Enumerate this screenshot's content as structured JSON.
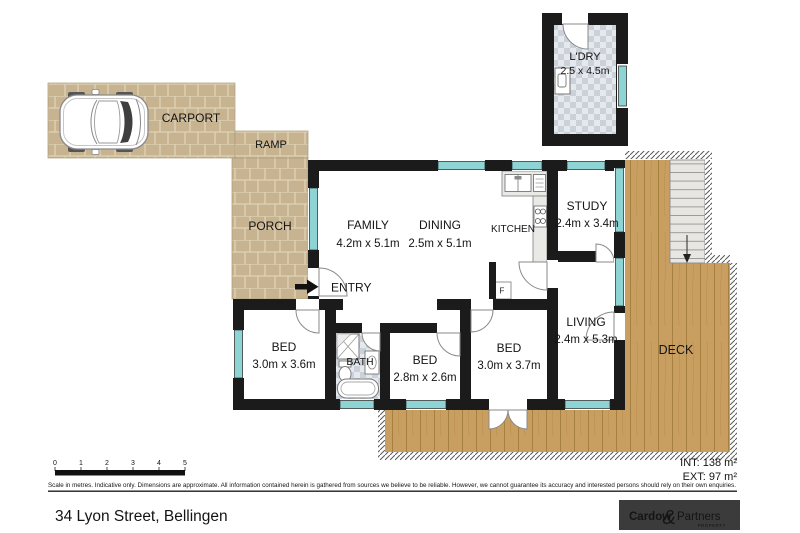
{
  "plan": {
    "rooms": {
      "carport": {
        "label": "CARPORT"
      },
      "ramp": {
        "label": "RAMP"
      },
      "porch": {
        "label": "PORCH"
      },
      "laundry": {
        "label": "L'DRY",
        "dims": "2.5 x 4.5m"
      },
      "family": {
        "label": "FAMILY",
        "dims": "4.2m x 5.1m"
      },
      "dining": {
        "label": "DINING",
        "dims": "2.5m x 5.1m"
      },
      "kitchen": {
        "label": "KITCHEN"
      },
      "study": {
        "label": "STUDY",
        "dims": "2.4m x 3.4m"
      },
      "entry": {
        "label": "ENTRY"
      },
      "bed1": {
        "label": "BED",
        "dims": "3.0m x 3.6m"
      },
      "bath": {
        "label": "BATH"
      },
      "bed2": {
        "label": "BED",
        "dims": "2.8m x 2.6m"
      },
      "bed3": {
        "label": "BED",
        "dims": "3.0m x 3.7m"
      },
      "living": {
        "label": "LIVING",
        "dims": "2.4m x 5.3m"
      },
      "deck": {
        "label": "DECK"
      },
      "fridge": {
        "label": "F"
      }
    },
    "areas": {
      "internal": "INT: 138 m²",
      "external": "EXT: 97 m²"
    },
    "scale_bar": {
      "ticks": [
        "0",
        "1",
        "2",
        "3",
        "4",
        "5"
      ]
    },
    "disclaimer": "Scale in metres. Indicative only. Dimensions are approximate. All information contained herein is gathered from sources we believe to be reliable. However, we cannot guarantee its accuracy and interested persons should rely on their own enquiries."
  },
  "footer": {
    "address": "34 Lyon Street, Bellingen",
    "logo": {
      "name_left": "Cardow",
      "ampersand": "&",
      "name_right": "Partners",
      "subtitle": "PROPERTY"
    }
  },
  "colors": {
    "wall": "#1b1b1b",
    "window_teal": "#8fd4d4",
    "paver": "#c8b391",
    "deck_wood": "#c89f61",
    "logo_teal": "#46b7c6",
    "logo_bg": "#3b3b3b"
  }
}
